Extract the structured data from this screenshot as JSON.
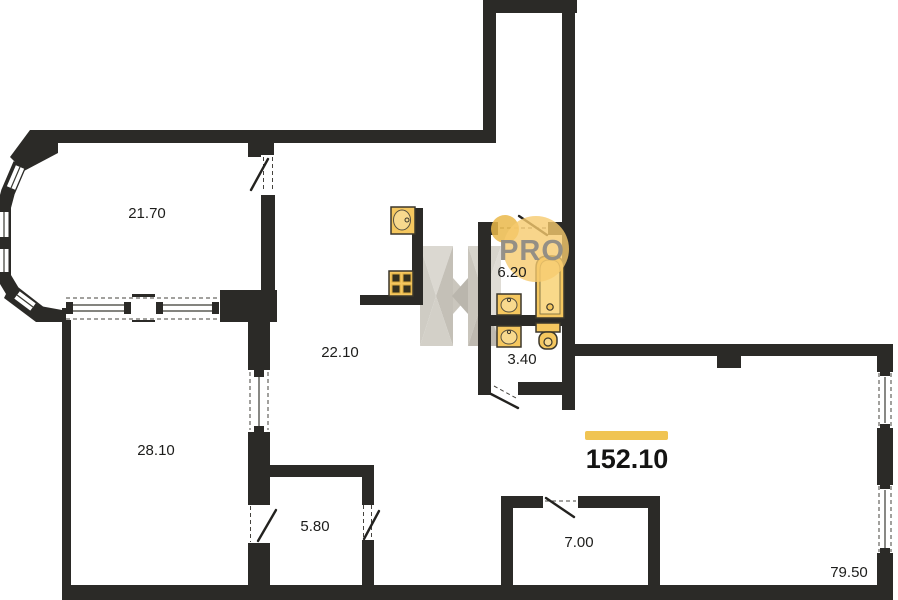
{
  "plan": {
    "type": "apartment-floorplan",
    "watermark_text": "PRO",
    "total_area": {
      "value": "152.10"
    },
    "rooms": [
      {
        "name": "room-top-left",
        "area": "21.70"
      },
      {
        "name": "room-bottom-left",
        "area": "28.10"
      },
      {
        "name": "room-kitchen-living",
        "area": "22.10"
      },
      {
        "name": "room-bathroom",
        "area": "6.20"
      },
      {
        "name": "room-wc",
        "area": "3.40"
      },
      {
        "name": "room-closet",
        "area": "5.80"
      },
      {
        "name": "room-storage",
        "area": "7.00"
      },
      {
        "name": "room-main-hall",
        "area": "79.50"
      }
    ],
    "fixtures": [
      {
        "name": "kitchen-sink-icon"
      },
      {
        "name": "stove-icon"
      },
      {
        "name": "bathtub-icon"
      },
      {
        "name": "sink-icon"
      },
      {
        "name": "sink-icon"
      },
      {
        "name": "toilet-icon"
      }
    ],
    "colors": {
      "wall": "#2b2a27",
      "accent_gold": "#f0c453",
      "fixture_gold": "#f5c75f",
      "badge_fill": "#f6cb6e",
      "badge_text": "#8f8c85",
      "watermark_light": "#dedbd4",
      "watermark_dark": "#bdb9b0",
      "background": "#ffffff"
    }
  }
}
